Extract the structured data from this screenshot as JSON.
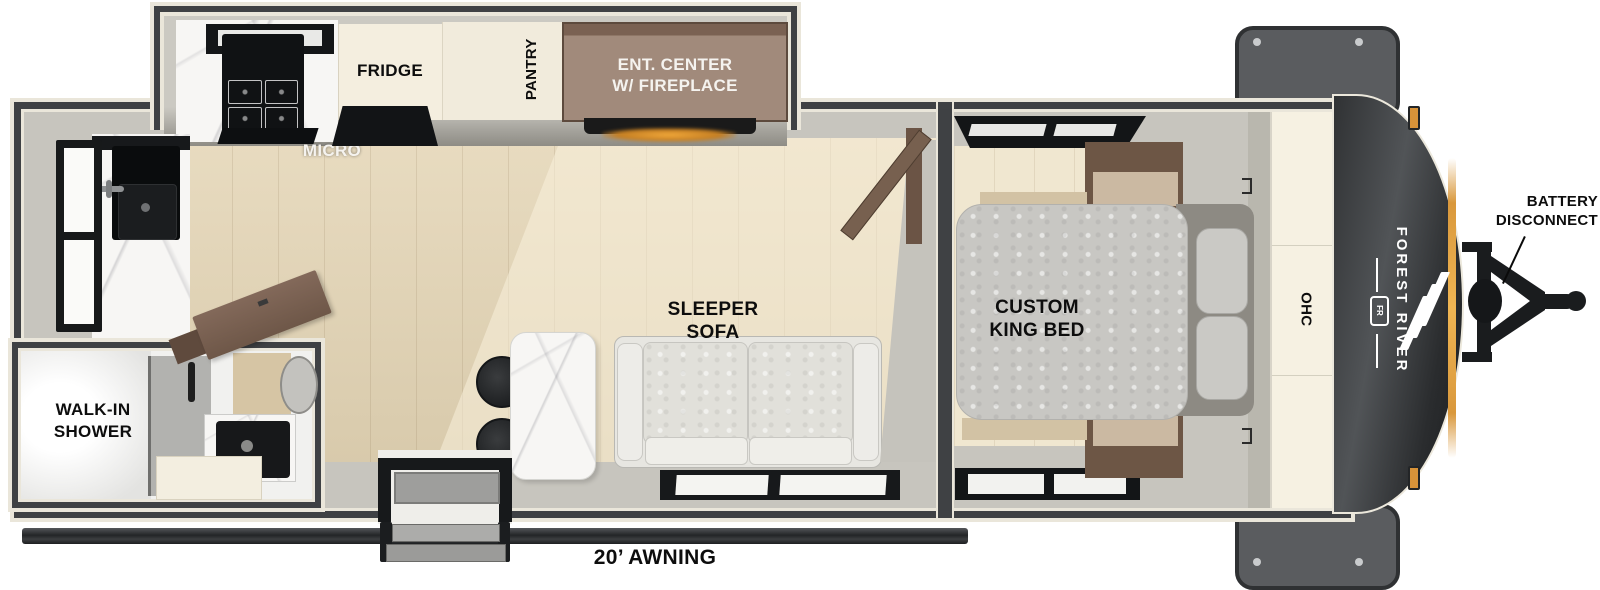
{
  "slideout_kitchen": {
    "micro_label": "MICRO",
    "fridge_label": "FRIDGE",
    "pantry_label": "PANTRY",
    "ent_center_label_line1": "ENT. CENTER",
    "ent_center_label_line2": "W/ FIREPLACE"
  },
  "living_area": {
    "sofa_label_line1": "SLEEPER",
    "sofa_label_line2": "SOFA"
  },
  "bedroom": {
    "bed_label_line1": "CUSTOM",
    "bed_label_line2": "KING BED",
    "ohc_label": "OHC"
  },
  "bathroom": {
    "shower_label_line1": "WALK-IN",
    "shower_label_line2": "SHOWER"
  },
  "exterior": {
    "awning_label": "20’ AWNING",
    "battery_label_line1": "BATTERY",
    "battery_label_line2": "DISCONNECT",
    "brand_name": "FOREST RIVER",
    "brand_monogram": "FR"
  },
  "colors": {
    "wall": "#3F4144",
    "outline_cream": "#EAE6DA",
    "wood_floor": "#E4D5B5",
    "bedroom_floor": "#F0E7D0",
    "interior_gray": "#CBC9C2",
    "cabinet_brown": "#9A8273",
    "cabinet_cream": "#F4EEDF",
    "appliance_black": "#131517",
    "marble": "#F7F6F4",
    "accent_amber": "#E09A3D",
    "front_cap": "#2E3033",
    "label_black": "#0D0D0D",
    "label_white": "#F5F3EF"
  }
}
